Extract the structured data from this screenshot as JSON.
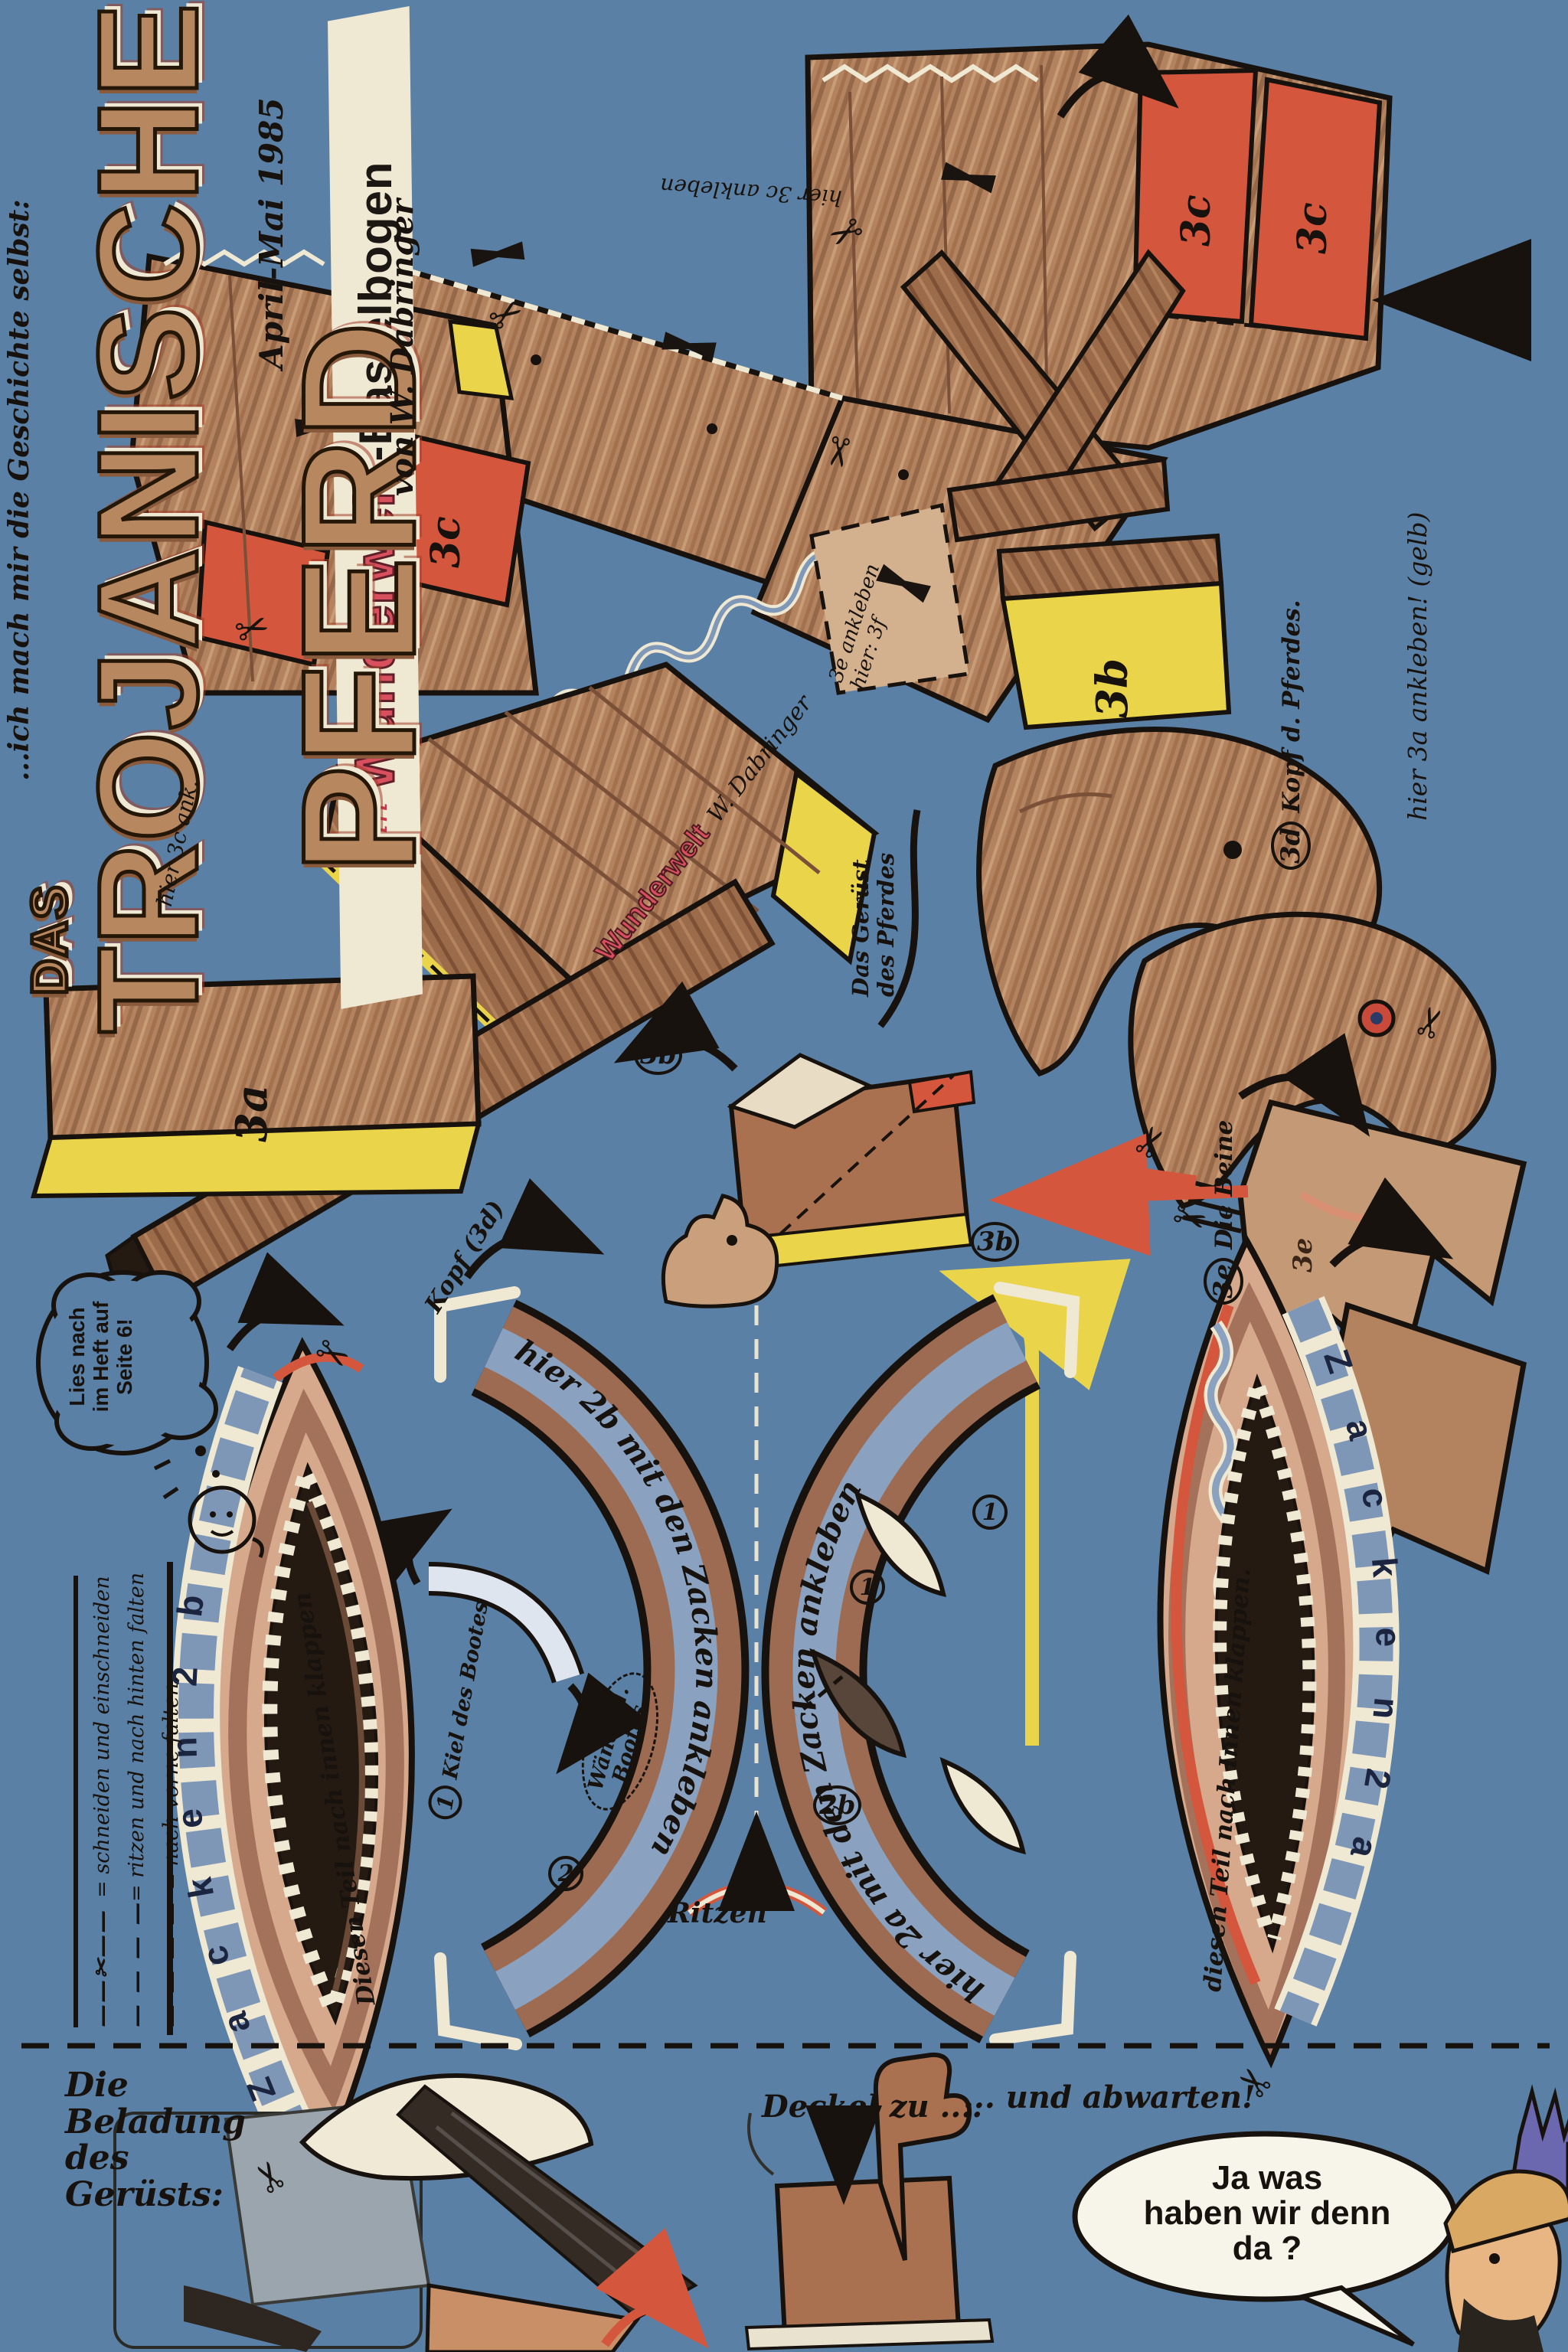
{
  "icons": {
    "scissors": "✂"
  },
  "header": {
    "intro_script": "...ich mach mir die Geschichte selbst:",
    "das": "DAS",
    "title_word1": "TROJANISCHE",
    "title_word2": "PFERD",
    "banner_ein": "ein",
    "banner_brand": "Wunderwelt",
    "banner_suffix": "-Bastelbogen",
    "date_note": "April-Mai 1985",
    "author_note": "von W. Dabringer"
  },
  "annotations": {
    "glue_3c_top": "hier 3c ankleben",
    "glue_3c_left": "hier 3c ank.",
    "glue_3a_right": "hier 3a ankleben! (gelb)",
    "patch_3e_line1": "3e ankleben",
    "patch_3e_line2": "hier: 3f",
    "geruest_line1": "Das Gerüst",
    "geruest_line2": "des Pferdes",
    "kopf_num": "3d",
    "kopf_label": "Kopf d. Pferdes.",
    "beine_num": "3e",
    "beine_label": "Die Beine",
    "kopf_3d_note": "Kopf (3d)",
    "ritzen": "Ritzen",
    "kiel_num": "1",
    "kiel_label": "Kiel des Bootes",
    "waende_num": "2",
    "waende_line1": "Wände d.",
    "waende_line2": "Bootes",
    "glue_2b_curve": "hier 2b mit den Zacken ankleben",
    "glue_2a_curve": "hier 2a mit den Zacken ankleben",
    "flap_left": "Diesen Teil nach innen klappen",
    "flap_right": "diesen Teil nach Innen klappen.",
    "zacken_left": "Z a c k e n   2 b",
    "zacken_right": "Z a c k e n   2 a"
  },
  "piece_labels": {
    "p3a": "3a",
    "p3b": "3b",
    "p3c": "3c",
    "c3b": "3b",
    "c3e": "3e",
    "c1": "1",
    "c2": "2",
    "c2b": "2b",
    "small_3e": "3e"
  },
  "crate": {
    "brand": "Wunderwelt",
    "signature": "W. Dabringer"
  },
  "legend": {
    "rows": [
      {
        "sample": "——✂——",
        "label": "= schneiden und einschneiden"
      },
      {
        "sample": "— — — —",
        "label": "= ritzen und nach hinten falten"
      },
      {
        "sample": "—·—·—·—",
        "label": "= nach vorne falten."
      }
    ]
  },
  "bubble": {
    "line1": "Lies nach",
    "line2": "im Heft auf",
    "line3": "Seite 6!"
  },
  "bottom": {
    "beladung_line1": "Die Beladung",
    "beladung_line2": "des",
    "beladung_line3": "Gerüsts:",
    "deckel_left": "Deckel zu ....",
    "deckel_right": "... und abwarten!",
    "speech_line1": "Ja was",
    "speech_line2": "haben wir denn",
    "speech_line3": "da ?"
  }
}
